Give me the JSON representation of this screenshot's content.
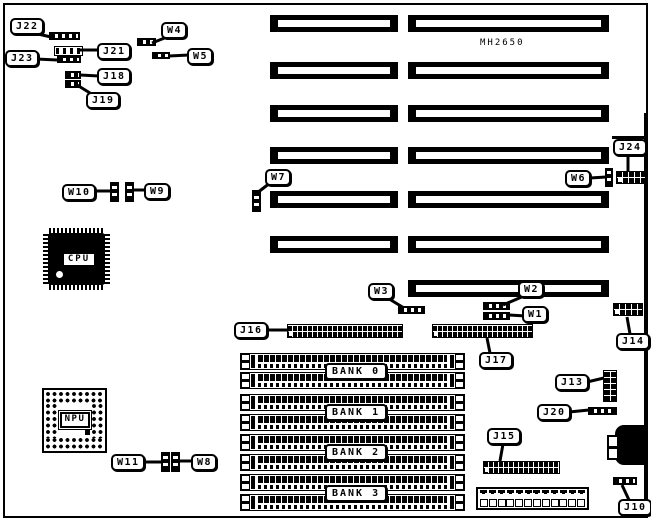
{
  "diagram": {
    "model": "MH2650",
    "chips": {
      "cpu": "CPU",
      "npu": "NPU"
    },
    "banks": [
      "BANK 0",
      "BANK 1",
      "BANK 2",
      "BANK 3"
    ],
    "callouts": {
      "j10": "J10",
      "j13": "J13",
      "j14": "J14",
      "j15": "J15",
      "j16": "J16",
      "j17": "J17",
      "j18": "J18",
      "j19": "J19",
      "j20": "J20",
      "j21": "J21",
      "j22": "J22",
      "j23": "J23",
      "j24": "J24",
      "w1": "W1",
      "w2": "W2",
      "w3": "W3",
      "w4": "W4",
      "w5": "W5",
      "w6": "W6",
      "w7": "W7",
      "w8": "W8",
      "w9": "W9",
      "w10": "W10",
      "w11": "W11"
    },
    "colors": {
      "ink": "#000000",
      "paper": "#ffffff"
    }
  }
}
